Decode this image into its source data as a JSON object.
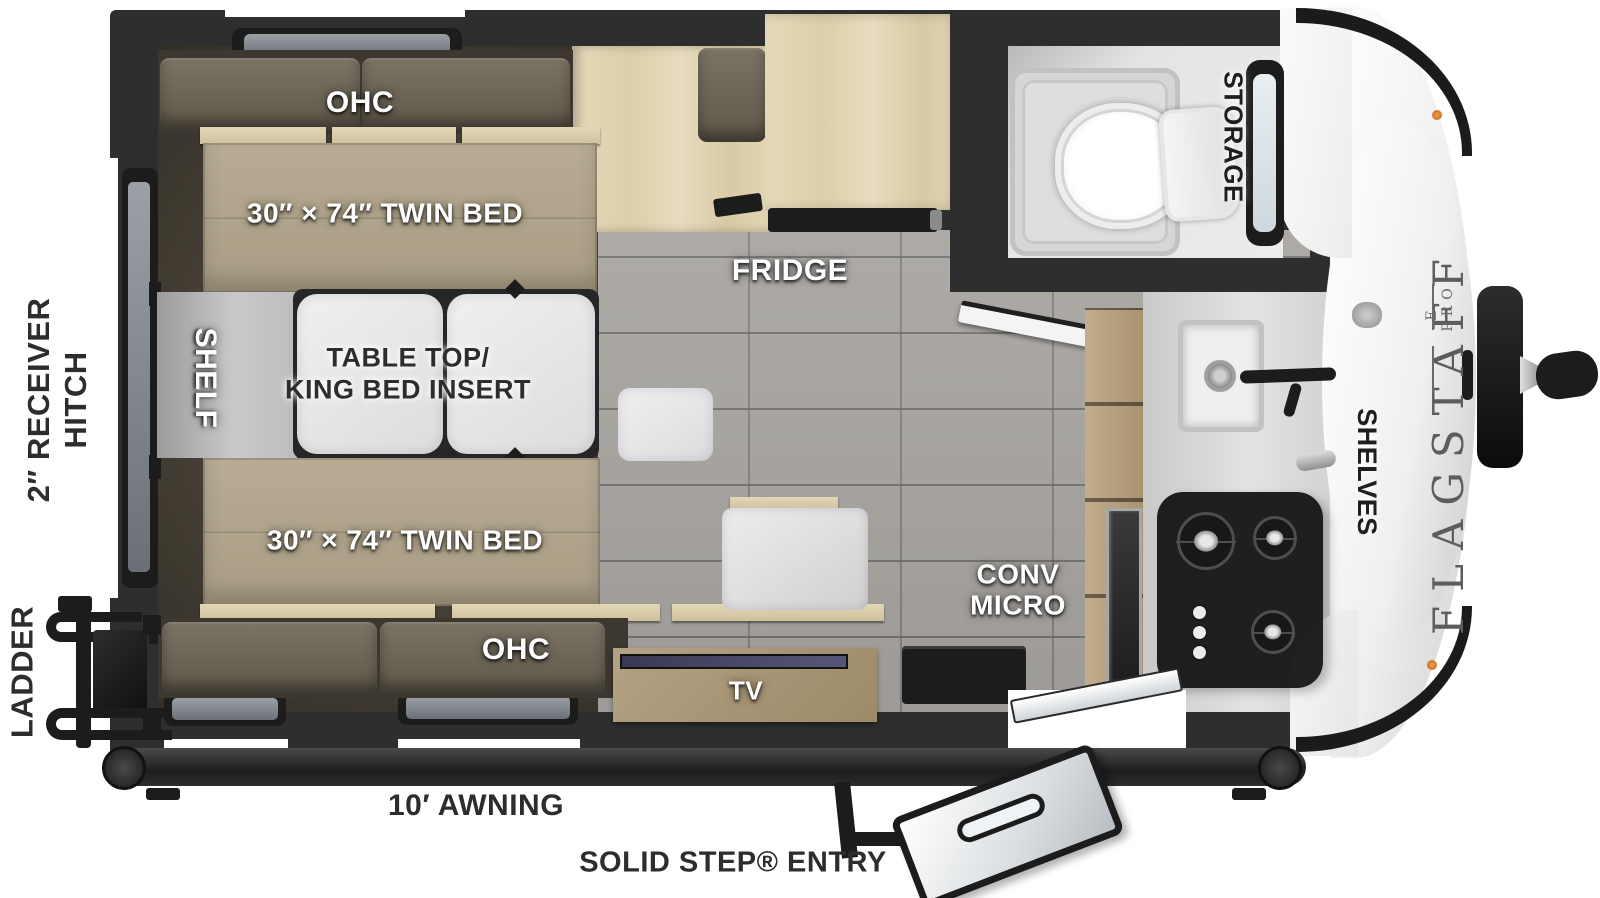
{
  "brand": {
    "name": "FLAGSTAFF",
    "sub": "E-PRO"
  },
  "labels": {
    "ohc_top": "OHC",
    "twin_bed_top": "30″ × 74″ TWIN BED",
    "table_line1": "TABLE TOP/",
    "table_line2": "KING BED INSERT",
    "shelf": "SHELF",
    "twin_bed_bottom": "30″ × 74″ TWIN BED",
    "ohc_bottom": "OHC",
    "tv": "TV",
    "fridge": "FRIDGE",
    "conv_line1": "CONV",
    "conv_line2": "MICRO",
    "storage": "STORAGE",
    "shelves": "SHELVES",
    "receiver_line1": "2″ RECEIVER",
    "receiver_line2": "HITCH",
    "ladder": "LADDER",
    "awning": "10′ AWNING",
    "entry": "SOLID STEP® ENTRY"
  },
  "colors": {
    "wall": "#2e2e2e",
    "mattress": "#b2a58b",
    "cushion": "#6f6859",
    "wood_light": "#e0d3b5",
    "wood_mid": "#b7a284",
    "tile_floor": "#a9a6a2",
    "counter": "#d9d9d9",
    "table_top": "#e8e8ea",
    "front_cap": "#f2f2f2",
    "cooktop": "#161616",
    "clearance_light": "#e08a3c"
  }
}
